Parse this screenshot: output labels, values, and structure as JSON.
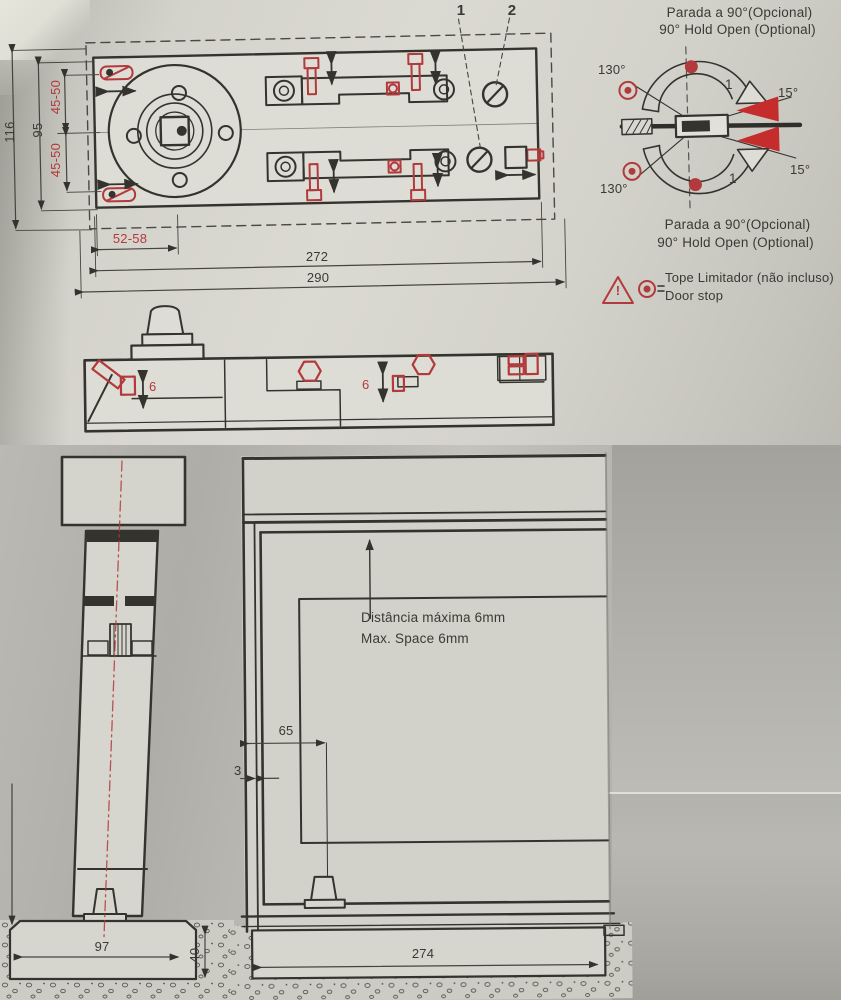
{
  "colors": {
    "accent_red": "#b23a3c",
    "line_dark": "#35332e"
  },
  "plan_view": {
    "callouts": {
      "valve1": "1",
      "valve2": "2"
    },
    "dimensions": {
      "overall_height": "116",
      "body_height": "95",
      "offset_top": "45-50",
      "offset_bottom": "45-50",
      "spindle_offset": "52-58",
      "body_length": "272",
      "overall_length": "290"
    }
  },
  "side_view": {
    "dimensions": {
      "adjust_left": "6",
      "adjust_right": "6"
    }
  },
  "swing_diagram": {
    "label_top_line1": "Parada a 90°(Opcional)",
    "label_top_line2": "90° Hold Open (Optional)",
    "label_bottom_line1": "Parada a 90°(Opcional)",
    "label_bottom_line2": "90° Hold Open (Optional)",
    "angles": {
      "open_top_left": "130°",
      "close_top_right": "15°",
      "open_bottom_left": "130°",
      "close_bottom_right": "15°"
    },
    "arc_labels": {
      "top": "1",
      "bottom": "1"
    }
  },
  "door_stop_note": {
    "warning_glyph": "!",
    "line1": "Tope Limitador (não incluso)",
    "line2": "Door stop"
  },
  "floor_section": {
    "dimensions": {
      "box_width": "97",
      "box_depth": "40"
    }
  },
  "door_elevation": {
    "note_line1": "Distância máxima 6mm",
    "note_line2": "Max. Space 6mm",
    "dimensions": {
      "pivot_offset": "65",
      "side_gap": "3",
      "box_length": "274"
    }
  }
}
